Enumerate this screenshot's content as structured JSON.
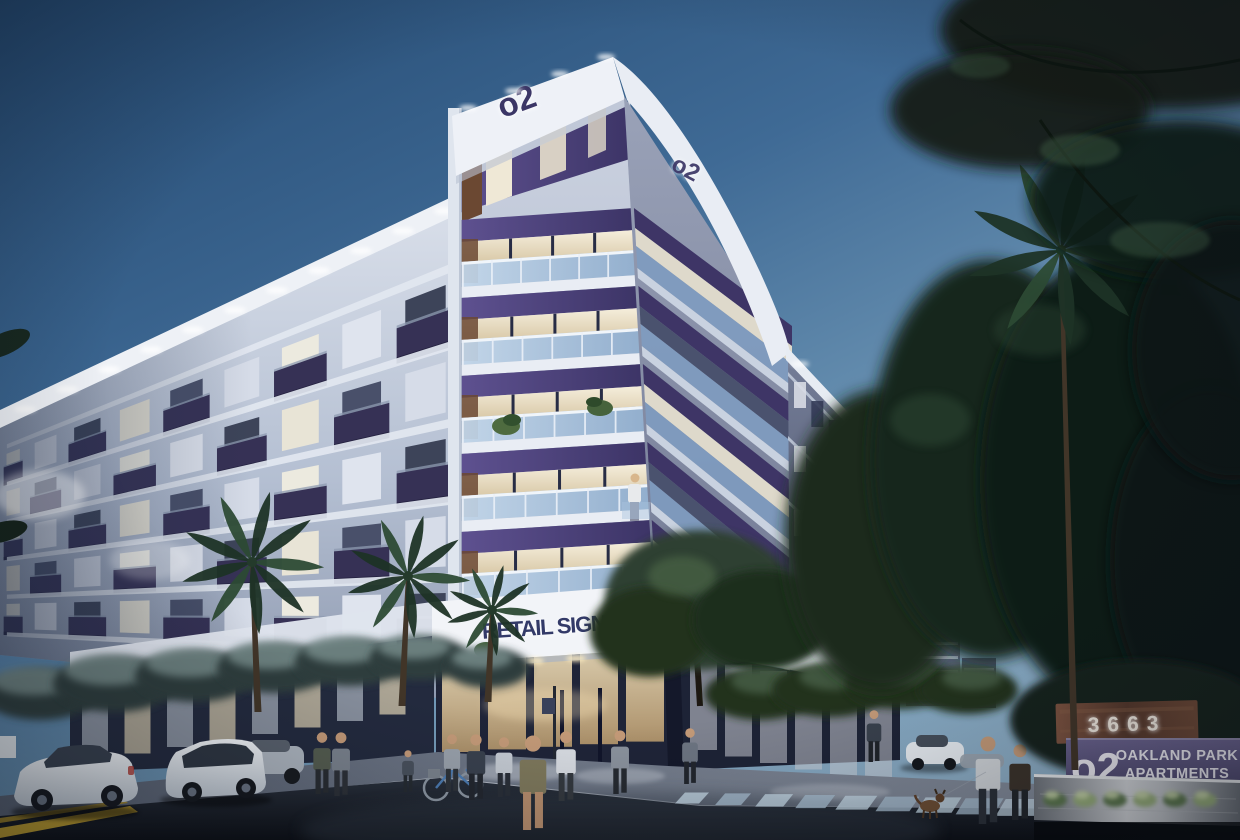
{
  "scene": {
    "building": {
      "logo_text": "o2",
      "retail_fascia_text": "RETAIL SIGNAGE",
      "corner_address_text": "3663",
      "left_wing": {
        "floors": 5,
        "bays": 9
      },
      "tower": {
        "floors": 5
      },
      "right_wing_rows": 3
    },
    "monument_sign": {
      "address": "3663",
      "logo": "o2",
      "name_line1": "OAKLAND PARK",
      "name_line2": "APARTMENTS"
    },
    "palette": {
      "sky_top": "#234870",
      "sky_mid": "#4d79a2",
      "sky_light": "#8fb0c8",
      "facade_light": "#d8dee9",
      "facade_shade": "#9aa5ba",
      "white_band": "#eef1f6",
      "balcony_navy": "#363155",
      "soffit_purple": "#5e5190",
      "soffit_deep": "#3c3466",
      "glass_blue": "#c3d7ea",
      "rail_blue": "#8fadcd",
      "window_warm": "#f0e9d8",
      "window_dark": "#3d4459",
      "wood_accent": "#6b4832",
      "storefront_navy": "#1f2438",
      "storefront_glow": "#f0e2c0",
      "asphalt": "#14181f",
      "sidewalk": "#8d95a3",
      "crosswalk": "#a7bdd0",
      "road_yellow": "#c9a52e",
      "foliage_dark": "#16251b",
      "shrub_frost": "#93aaa8",
      "palm_green": "#1e3326",
      "sign_wood": "#6e4936",
      "sign_purple": "#5b5380",
      "concrete": "#caccd0",
      "car_white": "#f4f7fa",
      "logo_navy": "#3b3666"
    }
  }
}
